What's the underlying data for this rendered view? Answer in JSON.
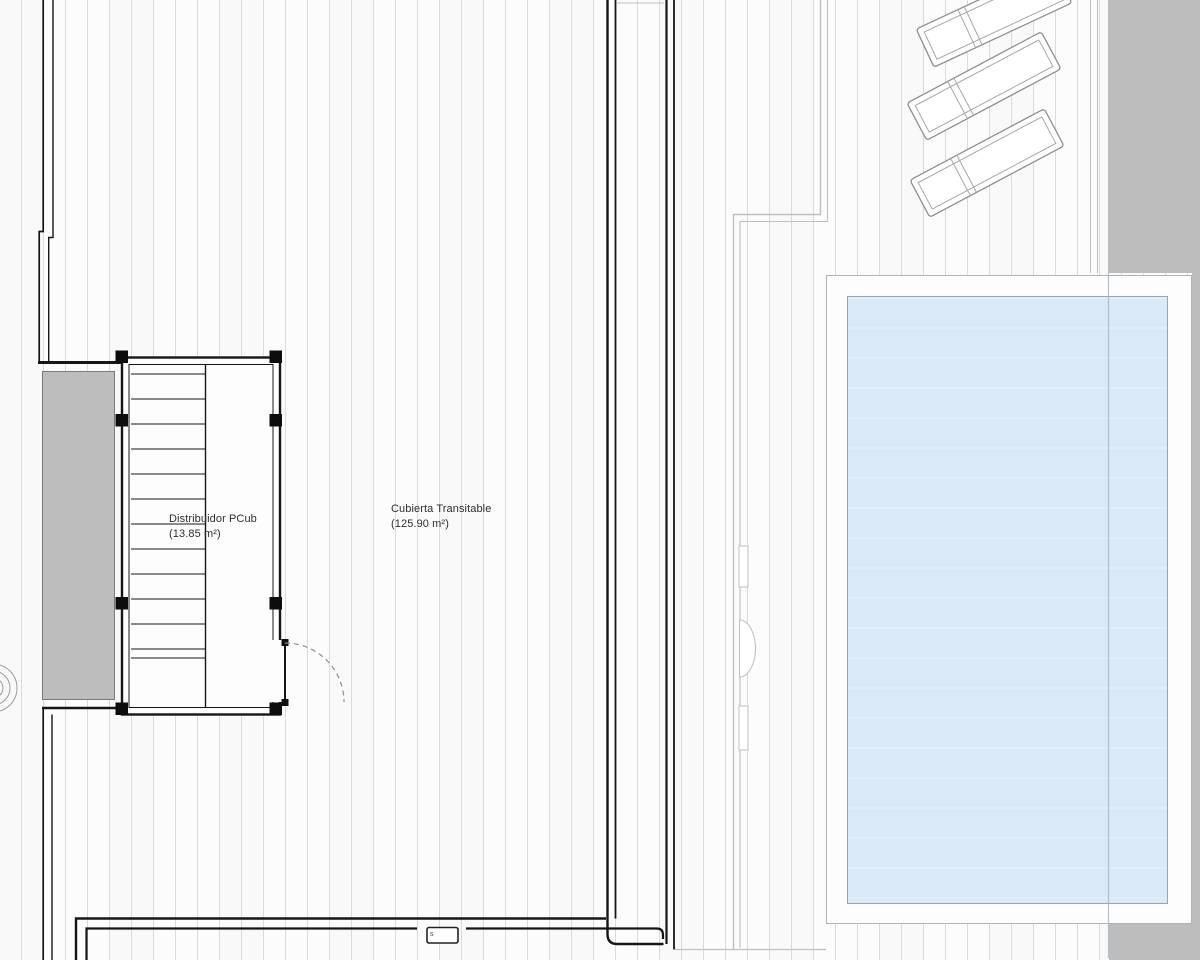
{
  "labels": {
    "stair_room": {
      "name": "Distribuidor PCub",
      "area": "(13.85 m²)"
    },
    "terrace": {
      "name": "Cubierta Transitable",
      "area": "(125.90 m²)"
    }
  },
  "annotations": {
    "utility_box_label": "s"
  },
  "furniture": {
    "loungers_count": 3
  },
  "colors": {
    "deck_bg": "#fcfcfc",
    "deck_line": "#dbdbdb",
    "wall_dark": "#161616",
    "gray_fill": "#bdbdbd",
    "gray_border": "#7a7a7a",
    "pool_fill": "#d9e9f8",
    "pool_border": "#93a6b6",
    "apron_border": "#b3b3b3",
    "light_line": "#bfbfbf",
    "door_arc": "#8c8c8c",
    "lounger_line": "#8f8f8f",
    "text": "#2e2e2e"
  }
}
